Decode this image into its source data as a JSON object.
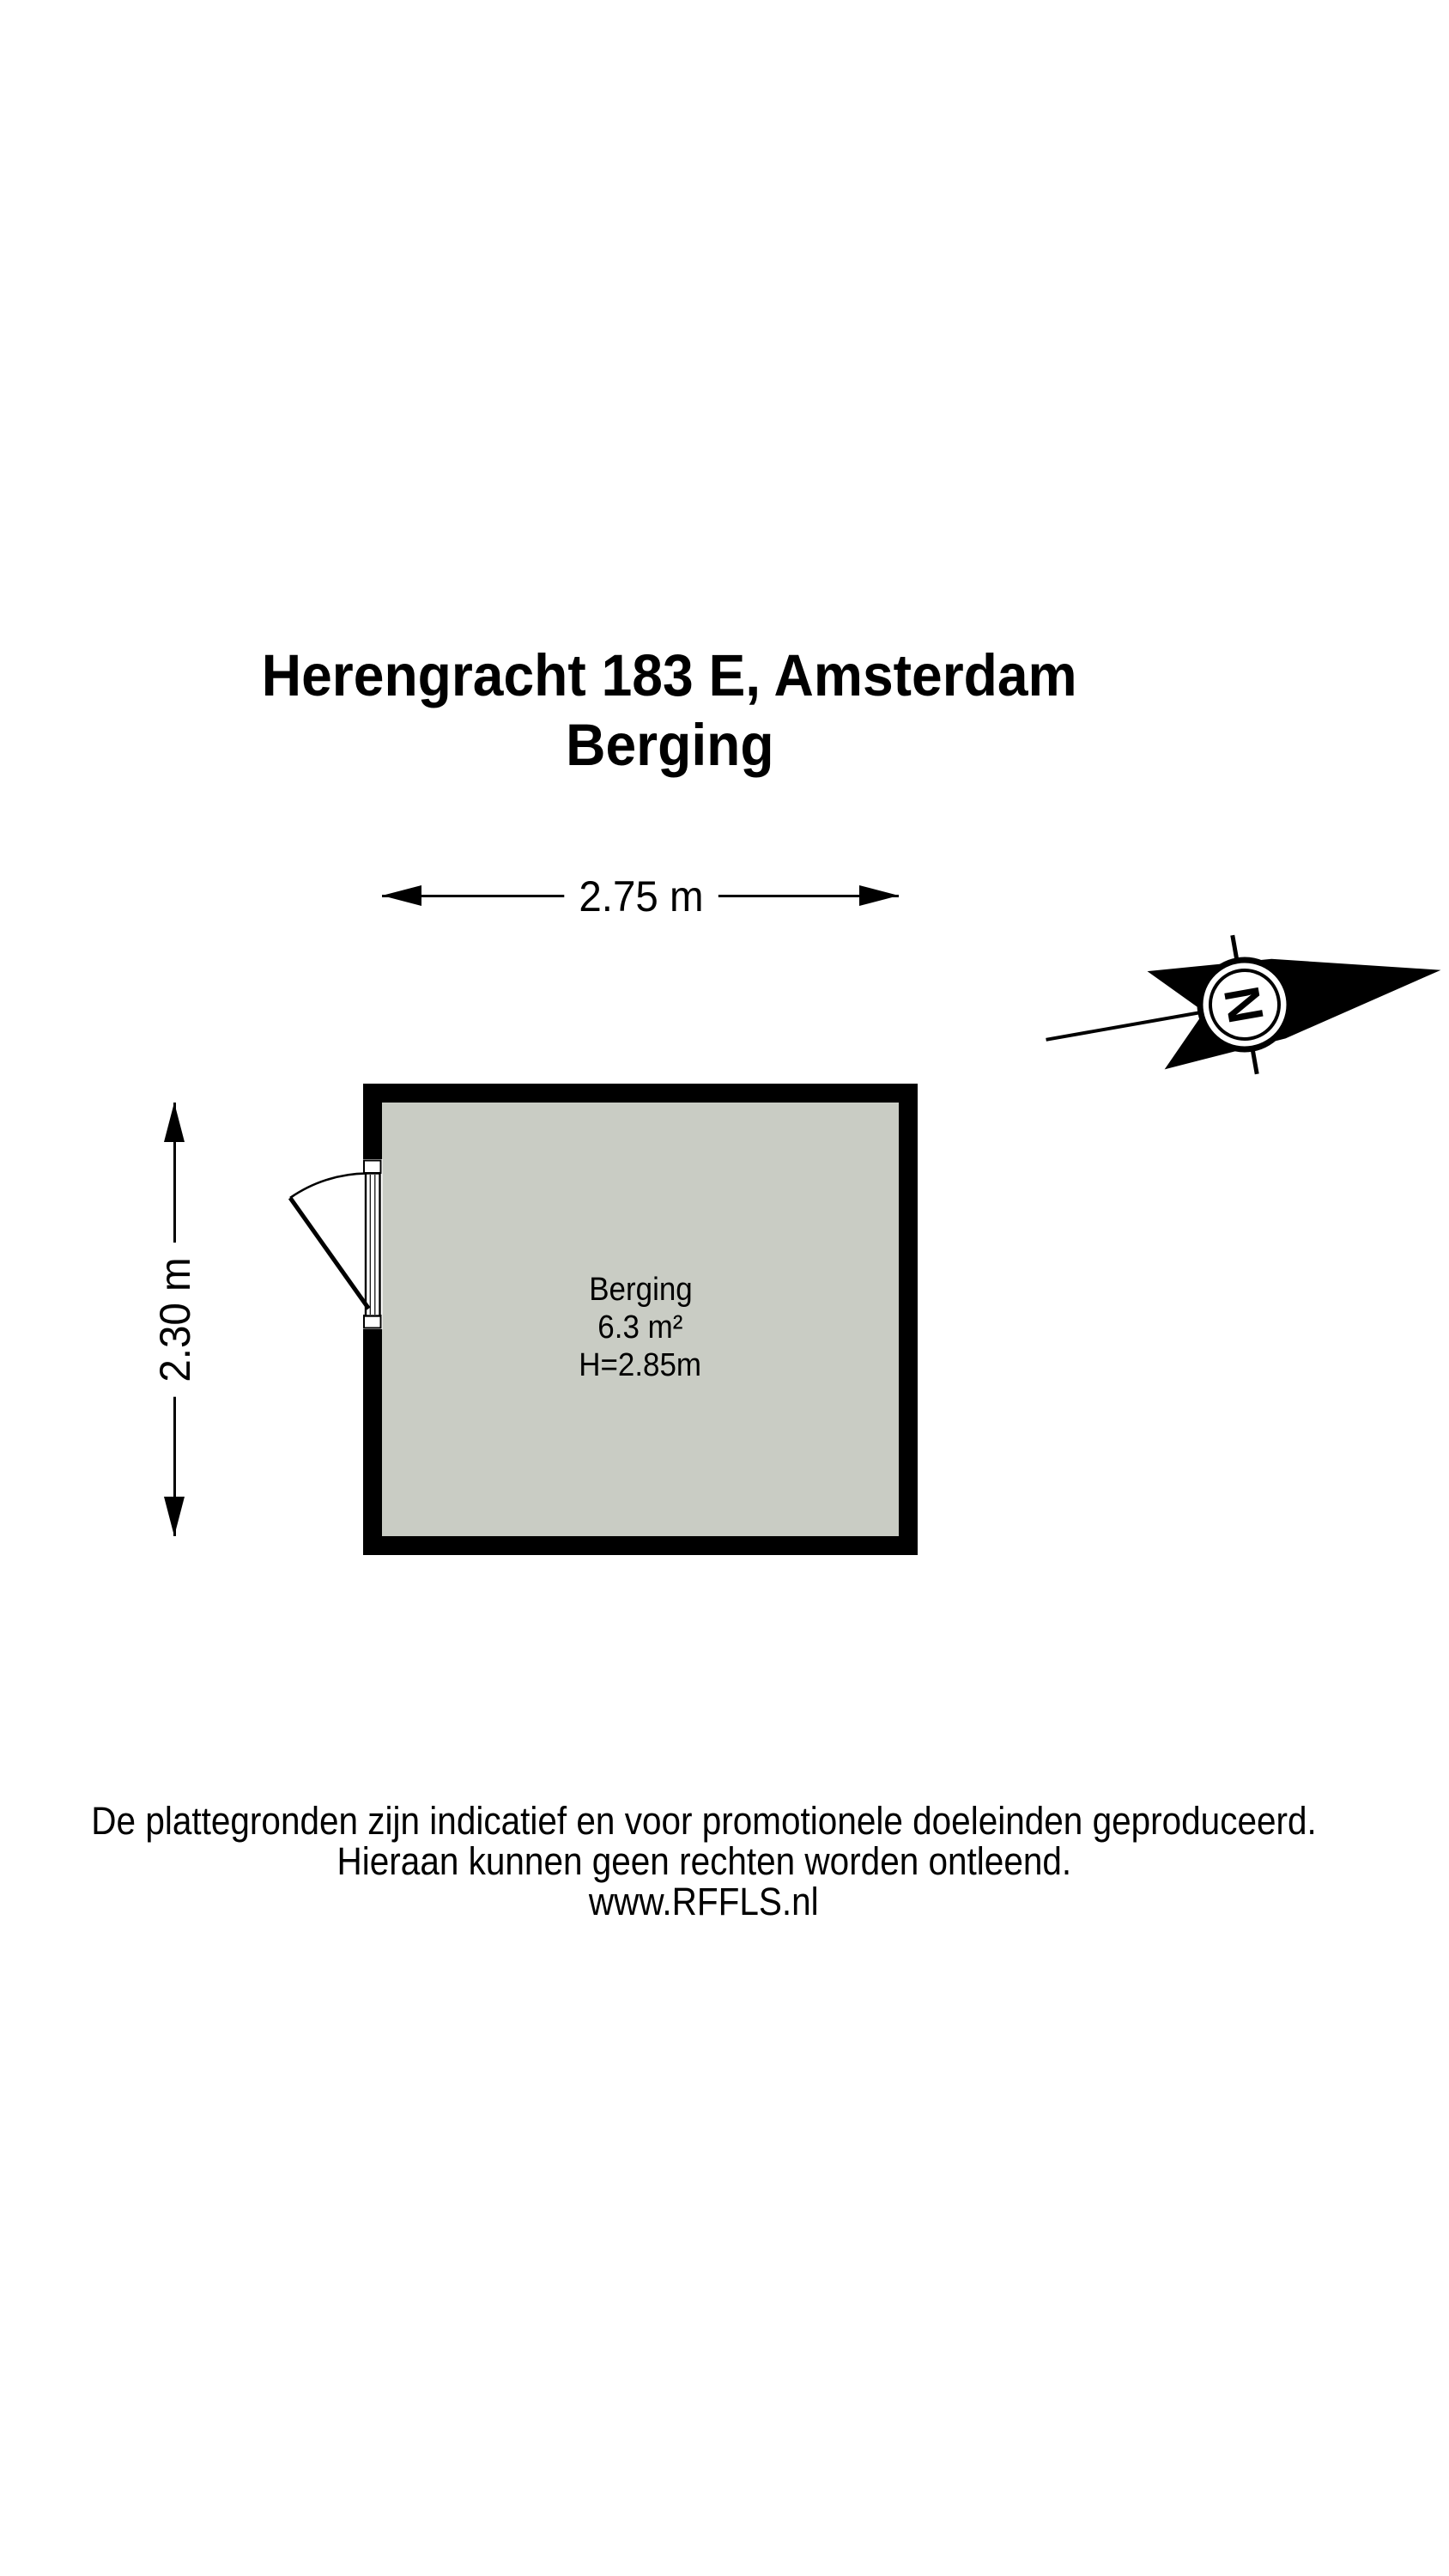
{
  "title": {
    "line1": "Herengracht 183 E, Amsterdam",
    "line2": "Berging"
  },
  "dimensions": {
    "width_label": "2.75 m",
    "height_label": "2.30 m"
  },
  "room": {
    "name": "Berging",
    "area": "6.3 m²",
    "ceiling_height": "H=2.85m"
  },
  "compass": {
    "north_letter": "N"
  },
  "footer": {
    "line1": "De plattegronden zijn indicatief en voor promotionele doeleinden geproduceerd.",
    "line2": "Hieraan kunnen geen rechten worden ontleend.",
    "line3": "www.RFFLS.nl"
  },
  "colors": {
    "wall": "#000000",
    "floor": "#c9ccc4"
  }
}
